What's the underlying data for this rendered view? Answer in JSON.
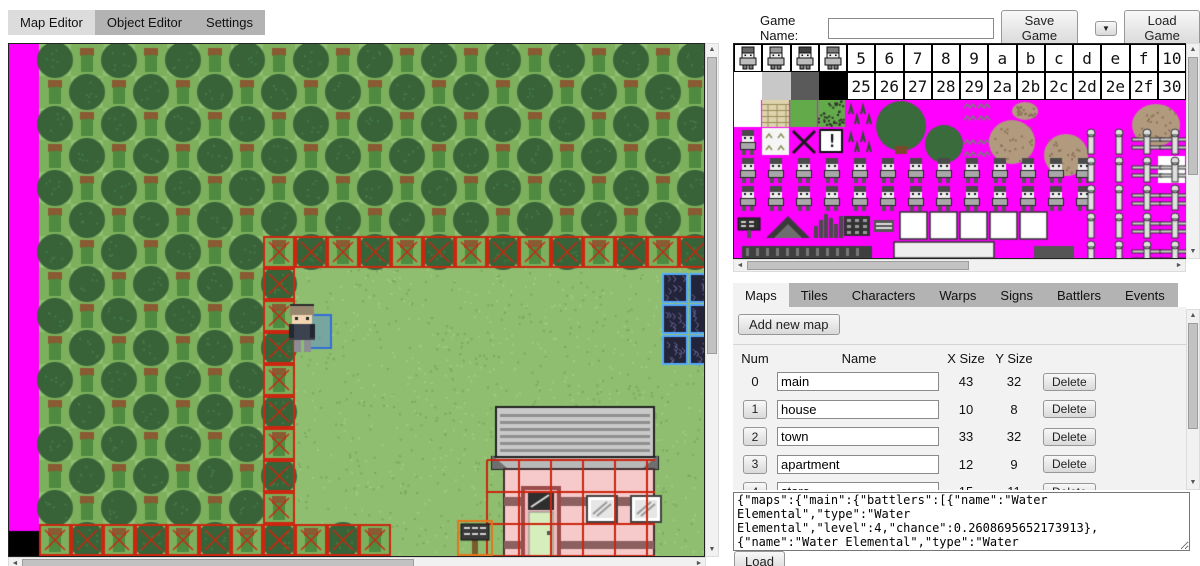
{
  "header": {
    "tabs": [
      {
        "label": "Map Editor",
        "active": true
      },
      {
        "label": "Object Editor",
        "active": false
      },
      {
        "label": "Settings",
        "active": false
      }
    ],
    "game_name_label": "Game Name:",
    "game_name_value": "",
    "save_button": "Save Game",
    "dropdown_arrow": "▼",
    "load_button": "Load Game"
  },
  "tileset": {
    "row1_sprites": [
      "person-sprite-1",
      "person-sprite-2",
      "person-sprite-3",
      "person-sprite-4"
    ],
    "row1_cells": [
      "5",
      "6",
      "7",
      "8",
      "9",
      "a",
      "b",
      "c",
      "d",
      "e",
      "f",
      "10"
    ],
    "row2_swatches": [
      "#ffffff",
      "#c8c8c8",
      "#5a5a5a",
      "#000000"
    ],
    "row2_cells": [
      "25",
      "26",
      "27",
      "28",
      "29",
      "2a",
      "2b",
      "2c",
      "2d",
      "2e",
      "2f",
      "30"
    ]
  },
  "panel_tabs": [
    {
      "label": "Maps",
      "active": true
    },
    {
      "label": "Tiles",
      "active": false
    },
    {
      "label": "Characters",
      "active": false
    },
    {
      "label": "Warps",
      "active": false
    },
    {
      "label": "Signs",
      "active": false
    },
    {
      "label": "Battlers",
      "active": false
    },
    {
      "label": "Events",
      "active": false
    }
  ],
  "maps_panel": {
    "add_button": "Add new map",
    "headers": [
      "Num",
      "Name",
      "X Size",
      "Y Size"
    ],
    "delete_label": "Delete",
    "rows": [
      {
        "num": "0",
        "name": "main",
        "x_size": "43",
        "y_size": "32",
        "num_is_button": false
      },
      {
        "num": "1",
        "name": "house",
        "x_size": "10",
        "y_size": "8",
        "num_is_button": true
      },
      {
        "num": "2",
        "name": "town",
        "x_size": "33",
        "y_size": "32",
        "num_is_button": true
      },
      {
        "num": "3",
        "name": "apartment",
        "x_size": "12",
        "y_size": "9",
        "num_is_button": true
      },
      {
        "num": "4",
        "name": "store",
        "x_size": "15",
        "y_size": "11",
        "num_is_button": true
      }
    ]
  },
  "json_output": "{\"maps\":{\"main\":{\"battlers\":[{\"name\":\"Water\nElemental\",\"type\":\"Water\nElemental\",\"level\":4,\"chance\":0.2608695652173913},\n{\"name\":\"Water Elemental\",\"type\":\"Water",
  "load_button": "Load",
  "map_view": {
    "colors": {
      "out_of_bounds": "#ff00ff",
      "void": "#000000",
      "grass": "#8fbe71",
      "grass_light": "#9ecd80",
      "grass_dark": "#7ba95c",
      "tree": "#386339",
      "tree_light": "#447a45",
      "trunk_bg": "#7cb05c",
      "trunk_cap": "#8a5a33",
      "trunk_body": "#4e8a40",
      "red_grid": "#cc2610",
      "highlight_fill": "rgba(80,130,230,0.4)",
      "highlight_border": "#2f6fd6",
      "blue_border": "#55aaff",
      "dark_tile": "#23233a",
      "dark_tile_pattern": "#6f6f9e",
      "roof": "#c9c9c9",
      "roof_stripe": "#8f8f8f",
      "wall": "#f6caca",
      "wall_stripe": "#8d6060",
      "door": "#d6edbc",
      "char_hair": "#97876f",
      "char_face": "#f2d6b4",
      "char_shirt": "#3c4250",
      "char_pants": "#8c8c94",
      "sign_board": "#3a3a3a",
      "sign_post": "#7a5a2e",
      "sign_highlight": "#e0761c"
    }
  }
}
